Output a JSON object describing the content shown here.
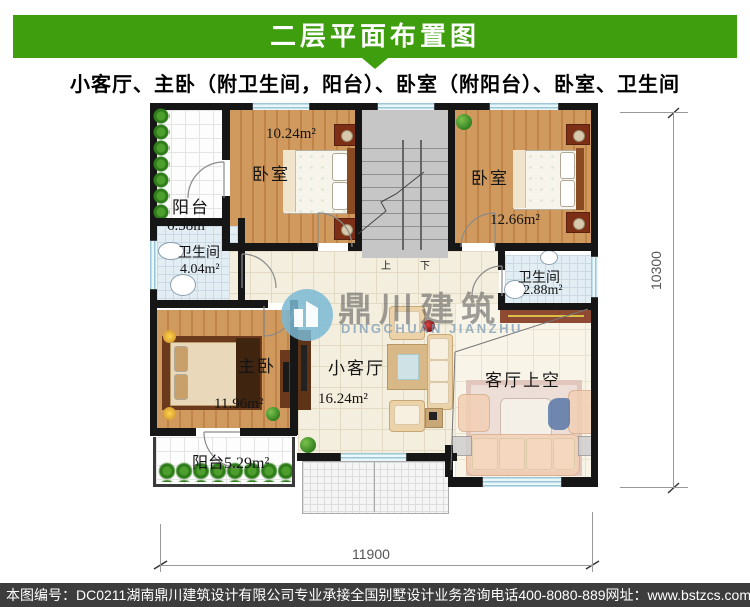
{
  "header": {
    "title": "二层平面布置图",
    "subtitle": "小客厅、主卧（附卫生间，阳台）、卧室（附阳台）、卧室、卫生间"
  },
  "rooms": {
    "balcony_top": {
      "name": "阳台",
      "area": "6.38m²"
    },
    "bedroom_left": {
      "name": "卧室",
      "area": "10.24m²"
    },
    "bedroom_right": {
      "name": "卧室",
      "area": "12.66m²"
    },
    "bath_left": {
      "name": "卫生间",
      "area": "4.04m²"
    },
    "bath_right": {
      "name": "卫生间",
      "area": "2.88m²"
    },
    "master": {
      "name": "主卧",
      "area": "11.96m²"
    },
    "living": {
      "name": "小客厅",
      "area": "16.24m²"
    },
    "void": {
      "name": "客厅上空"
    },
    "balcony_bottom": {
      "label": "阳台5.29m²"
    }
  },
  "stairs": {
    "up": "上",
    "down": "下"
  },
  "watermark": {
    "cn": "鼎川建筑",
    "en": "DINGCHUAN JIANZHU"
  },
  "dims": {
    "width": "11900",
    "height": "10300"
  },
  "footer": {
    "no": "本图编号：DC0211",
    "company": "湖南鼎川建筑设计有限公司专业承接全国别墅设计业务",
    "phone": "咨询电话400-8080-889",
    "site": "网址：www.bstzcs.com"
  },
  "colors": {
    "header_green": "#3f9e0e",
    "footer_gray": "#3d3d3d",
    "wall_black": "#161616",
    "wood_floor": "#cd9254",
    "window_blue": "#cdeaf4"
  }
}
